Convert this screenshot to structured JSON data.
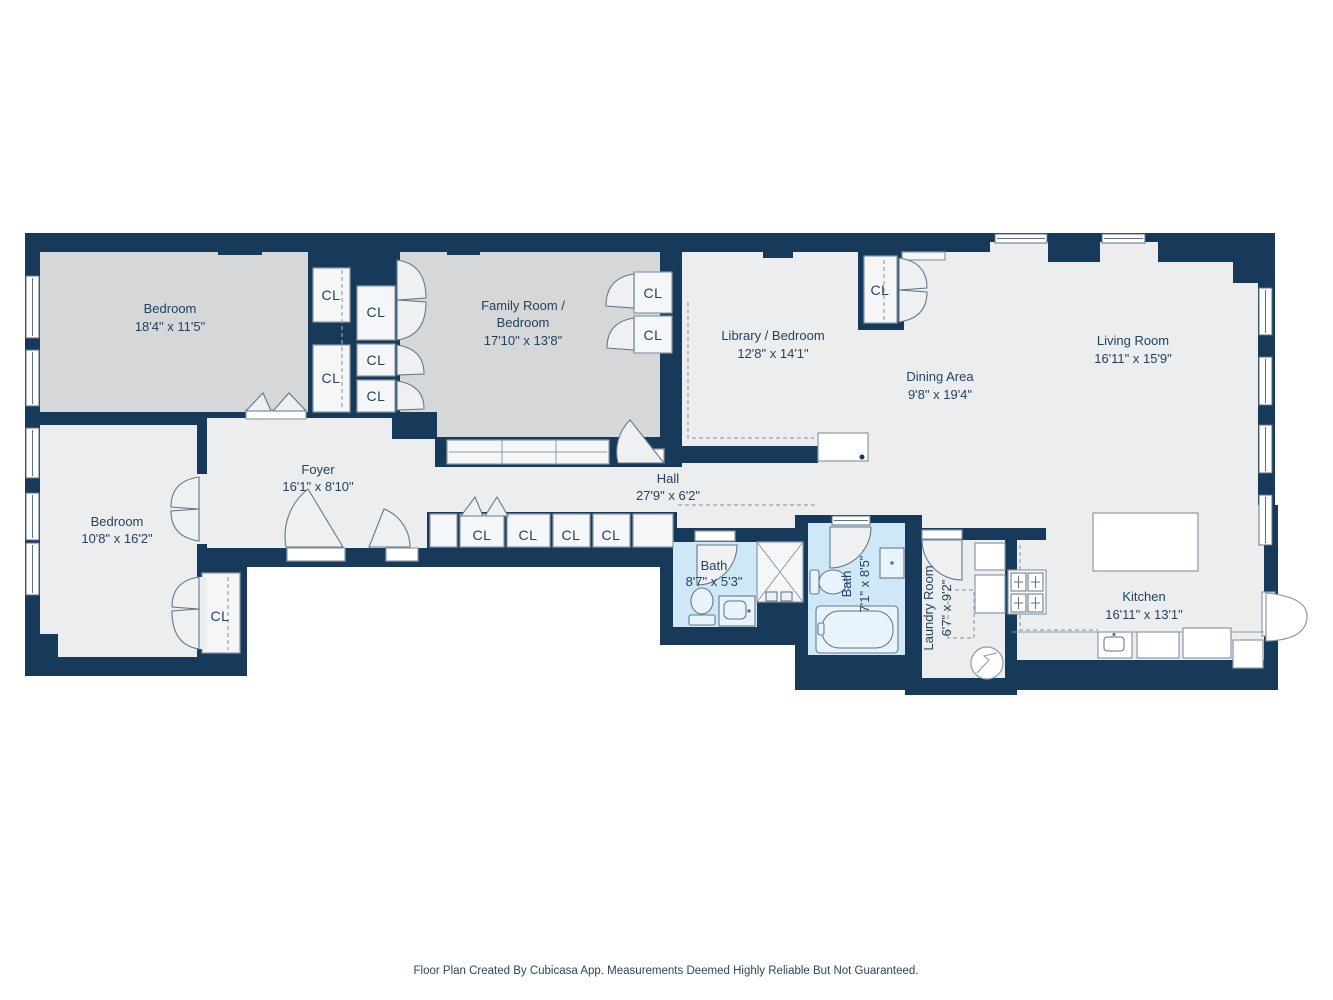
{
  "meta": {
    "footer": "Floor Plan Created By Cubicasa App. Measurements Deemed Highly Reliable But Not Guaranteed."
  },
  "colors": {
    "wall": "#17395a",
    "room_light": "#ecedee",
    "room_gray": "#d6d7d8",
    "bath_blue": "#cfe8f7",
    "text": "#24425e"
  },
  "rooms": [
    {
      "id": "bedroom-top",
      "name": "Bedroom",
      "dims": "18'4\" x 11'5\""
    },
    {
      "id": "family-room",
      "name_line1": "Family Room /",
      "name_line2": "Bedroom",
      "dims": "17'10\" x 13'8\""
    },
    {
      "id": "library",
      "name": "Library / Bedroom",
      "dims": "12'8\" x 14'1\""
    },
    {
      "id": "dining-area",
      "name": "Dining Area",
      "dims": "9'8\" x 19'4\""
    },
    {
      "id": "living-room",
      "name": "Living Room",
      "dims": "16'11\" x 15'9\""
    },
    {
      "id": "bedroom-left",
      "name": "Bedroom",
      "dims": "10'8\" x 16'2\""
    },
    {
      "id": "foyer",
      "name": "Foyer",
      "dims": "16'1\" x 8'10\""
    },
    {
      "id": "hall",
      "name": "Hall",
      "dims": "27'9\" x 6'2\""
    },
    {
      "id": "bath-small",
      "name": "Bath",
      "dims": "8'7\" x 5'3\""
    },
    {
      "id": "bath-large",
      "name": "Bath",
      "dims": "7'1\" x 8'5\""
    },
    {
      "id": "laundry-room",
      "name": "Laundry Room",
      "dims": "6'7\" x 9'2\""
    },
    {
      "id": "kitchen",
      "name": "Kitchen",
      "dims": "16'11\" x 13'1\""
    }
  ],
  "closets": [
    {
      "label": "CL"
    },
    {
      "label": "CL"
    },
    {
      "label": "CL"
    },
    {
      "label": "CL"
    },
    {
      "label": "CL"
    },
    {
      "label": "CL"
    },
    {
      "label": "CL"
    },
    {
      "label": "CL"
    },
    {
      "label": "CL"
    },
    {
      "label": "CL"
    },
    {
      "label": "CL"
    },
    {
      "label": "CL"
    },
    {
      "label": "CL"
    }
  ]
}
